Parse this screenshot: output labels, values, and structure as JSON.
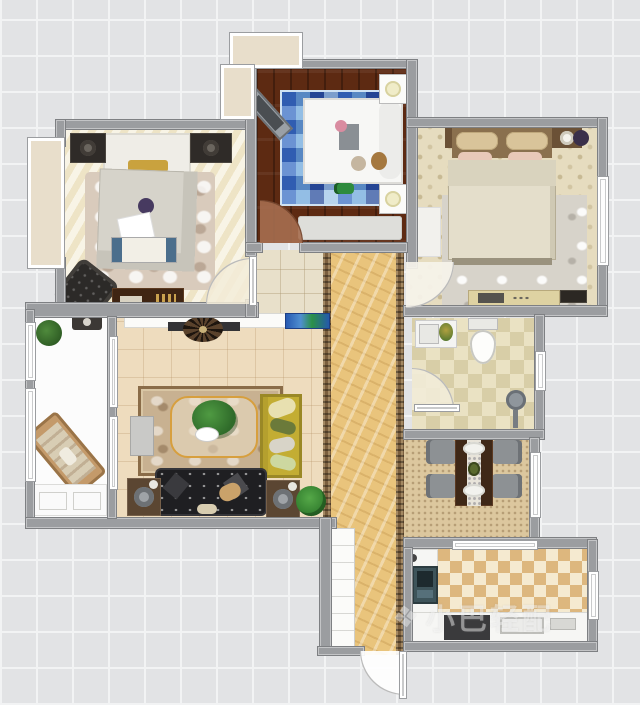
{
  "meta": {
    "kind": "2d-apartment-floor-plan-render",
    "canvas": {
      "width": 640,
      "height": 705
    }
  },
  "watermark": {
    "logo_glyph": "❖",
    "text": "小巴轻配"
  },
  "palette": {
    "background_grid": "#e2e3e5",
    "grid_line": "#f2f3f4",
    "wall": "#9b9da0",
    "bedroom_left_floor": "#f3ebd2",
    "kids_room_floor": "#5d2a12",
    "master_floor": "#e6dcbf",
    "living_floor": "#eedcbe",
    "corridor_marble": "#e9c47c",
    "mosaic_border": "#7b5f3e",
    "bathroom_tile": "#e3dab5",
    "dining_floor": "#dcc79e",
    "kitchen_tile": "#e9d1a7",
    "balcony_floor": "#fcfcfc",
    "sofa_black": "#1f1f22",
    "sofa_yellow": "#c3ad33",
    "kids_rug_blue": "#4f8fd0",
    "accent_wood_dark": "#3f2817",
    "aquarium_blue": "#2456b0"
  },
  "rooms": [
    {
      "id": "bedroom-left",
      "furniture": [
        "double-bed",
        "rug",
        "bench",
        "armchair",
        "tv-console",
        "nightstand-speakers",
        "bay-window"
      ]
    },
    {
      "id": "kids-bedroom",
      "furniture": [
        "single-bed",
        "blue-pixel-rug",
        "treadmill",
        "toy-car",
        "teddy-bear",
        "nightstand-lamps",
        "door"
      ]
    },
    {
      "id": "master-bedroom",
      "furniture": [
        "double-bed",
        "nightstand-lamps",
        "floral-rug",
        "tv-console",
        "dresser",
        "window"
      ]
    },
    {
      "id": "living-room",
      "furniture": [
        "tv-console",
        "ceiling-lamp",
        "aquarium",
        "ornate-rug",
        "coffee-table-flowers",
        "yellow-sofa",
        "black-tufted-sofa",
        "end-table-speakers",
        "potted-plant",
        "side-table"
      ]
    },
    {
      "id": "balcony",
      "furniture": [
        "plant",
        "grill-pan",
        "lounge-chair",
        "washing-cabinet"
      ]
    },
    {
      "id": "bathroom",
      "furniture": [
        "vanity",
        "toilet",
        "shower",
        "door"
      ]
    },
    {
      "id": "dining-room",
      "furniture": [
        "wood-table-runner",
        "four-gray-chairs",
        "plates"
      ]
    },
    {
      "id": "kitchen",
      "furniture": [
        "fridge",
        "counter",
        "stove",
        "sink",
        "window"
      ]
    },
    {
      "id": "corridor",
      "furniture": [
        "shoe-cabinet",
        "entry-door"
      ]
    }
  ]
}
